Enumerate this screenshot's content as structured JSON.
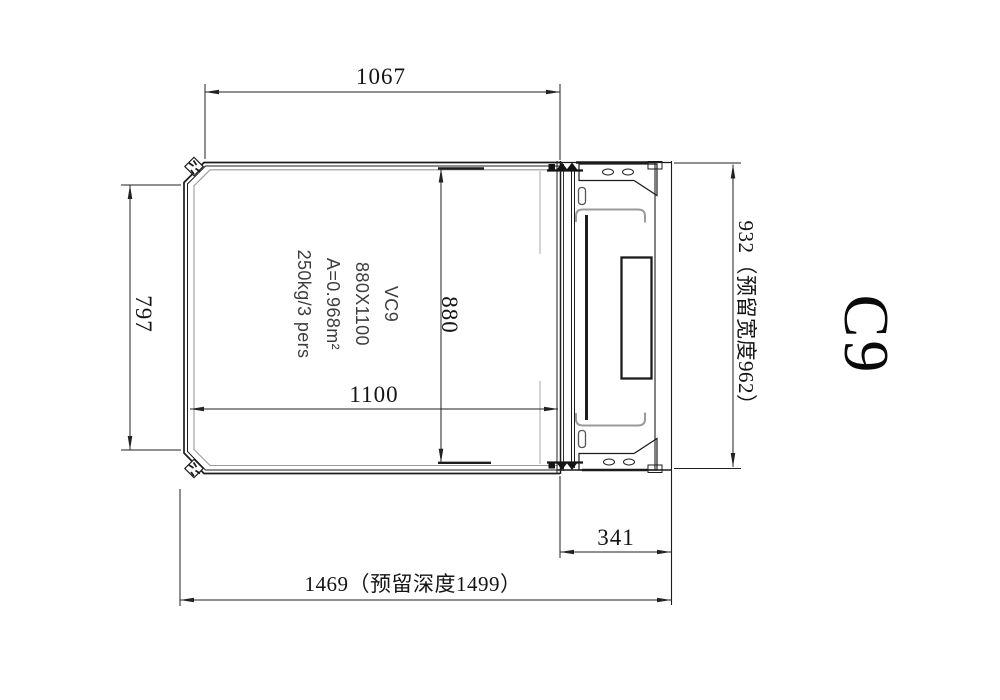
{
  "drawing": {
    "product_code": "C9",
    "dimensions": {
      "top_width": "1067",
      "left_height": "797",
      "cabin_height": "880",
      "cabin_width": "1100",
      "door_side": "341",
      "total_depth": "1469（预留深度1499）",
      "total_width": "932（预留宽度962）"
    },
    "cabin_label": {
      "model": "VC9",
      "size": "880X1100",
      "area": "A=0.968m²",
      "capacity": "250kg/3 pers"
    }
  }
}
